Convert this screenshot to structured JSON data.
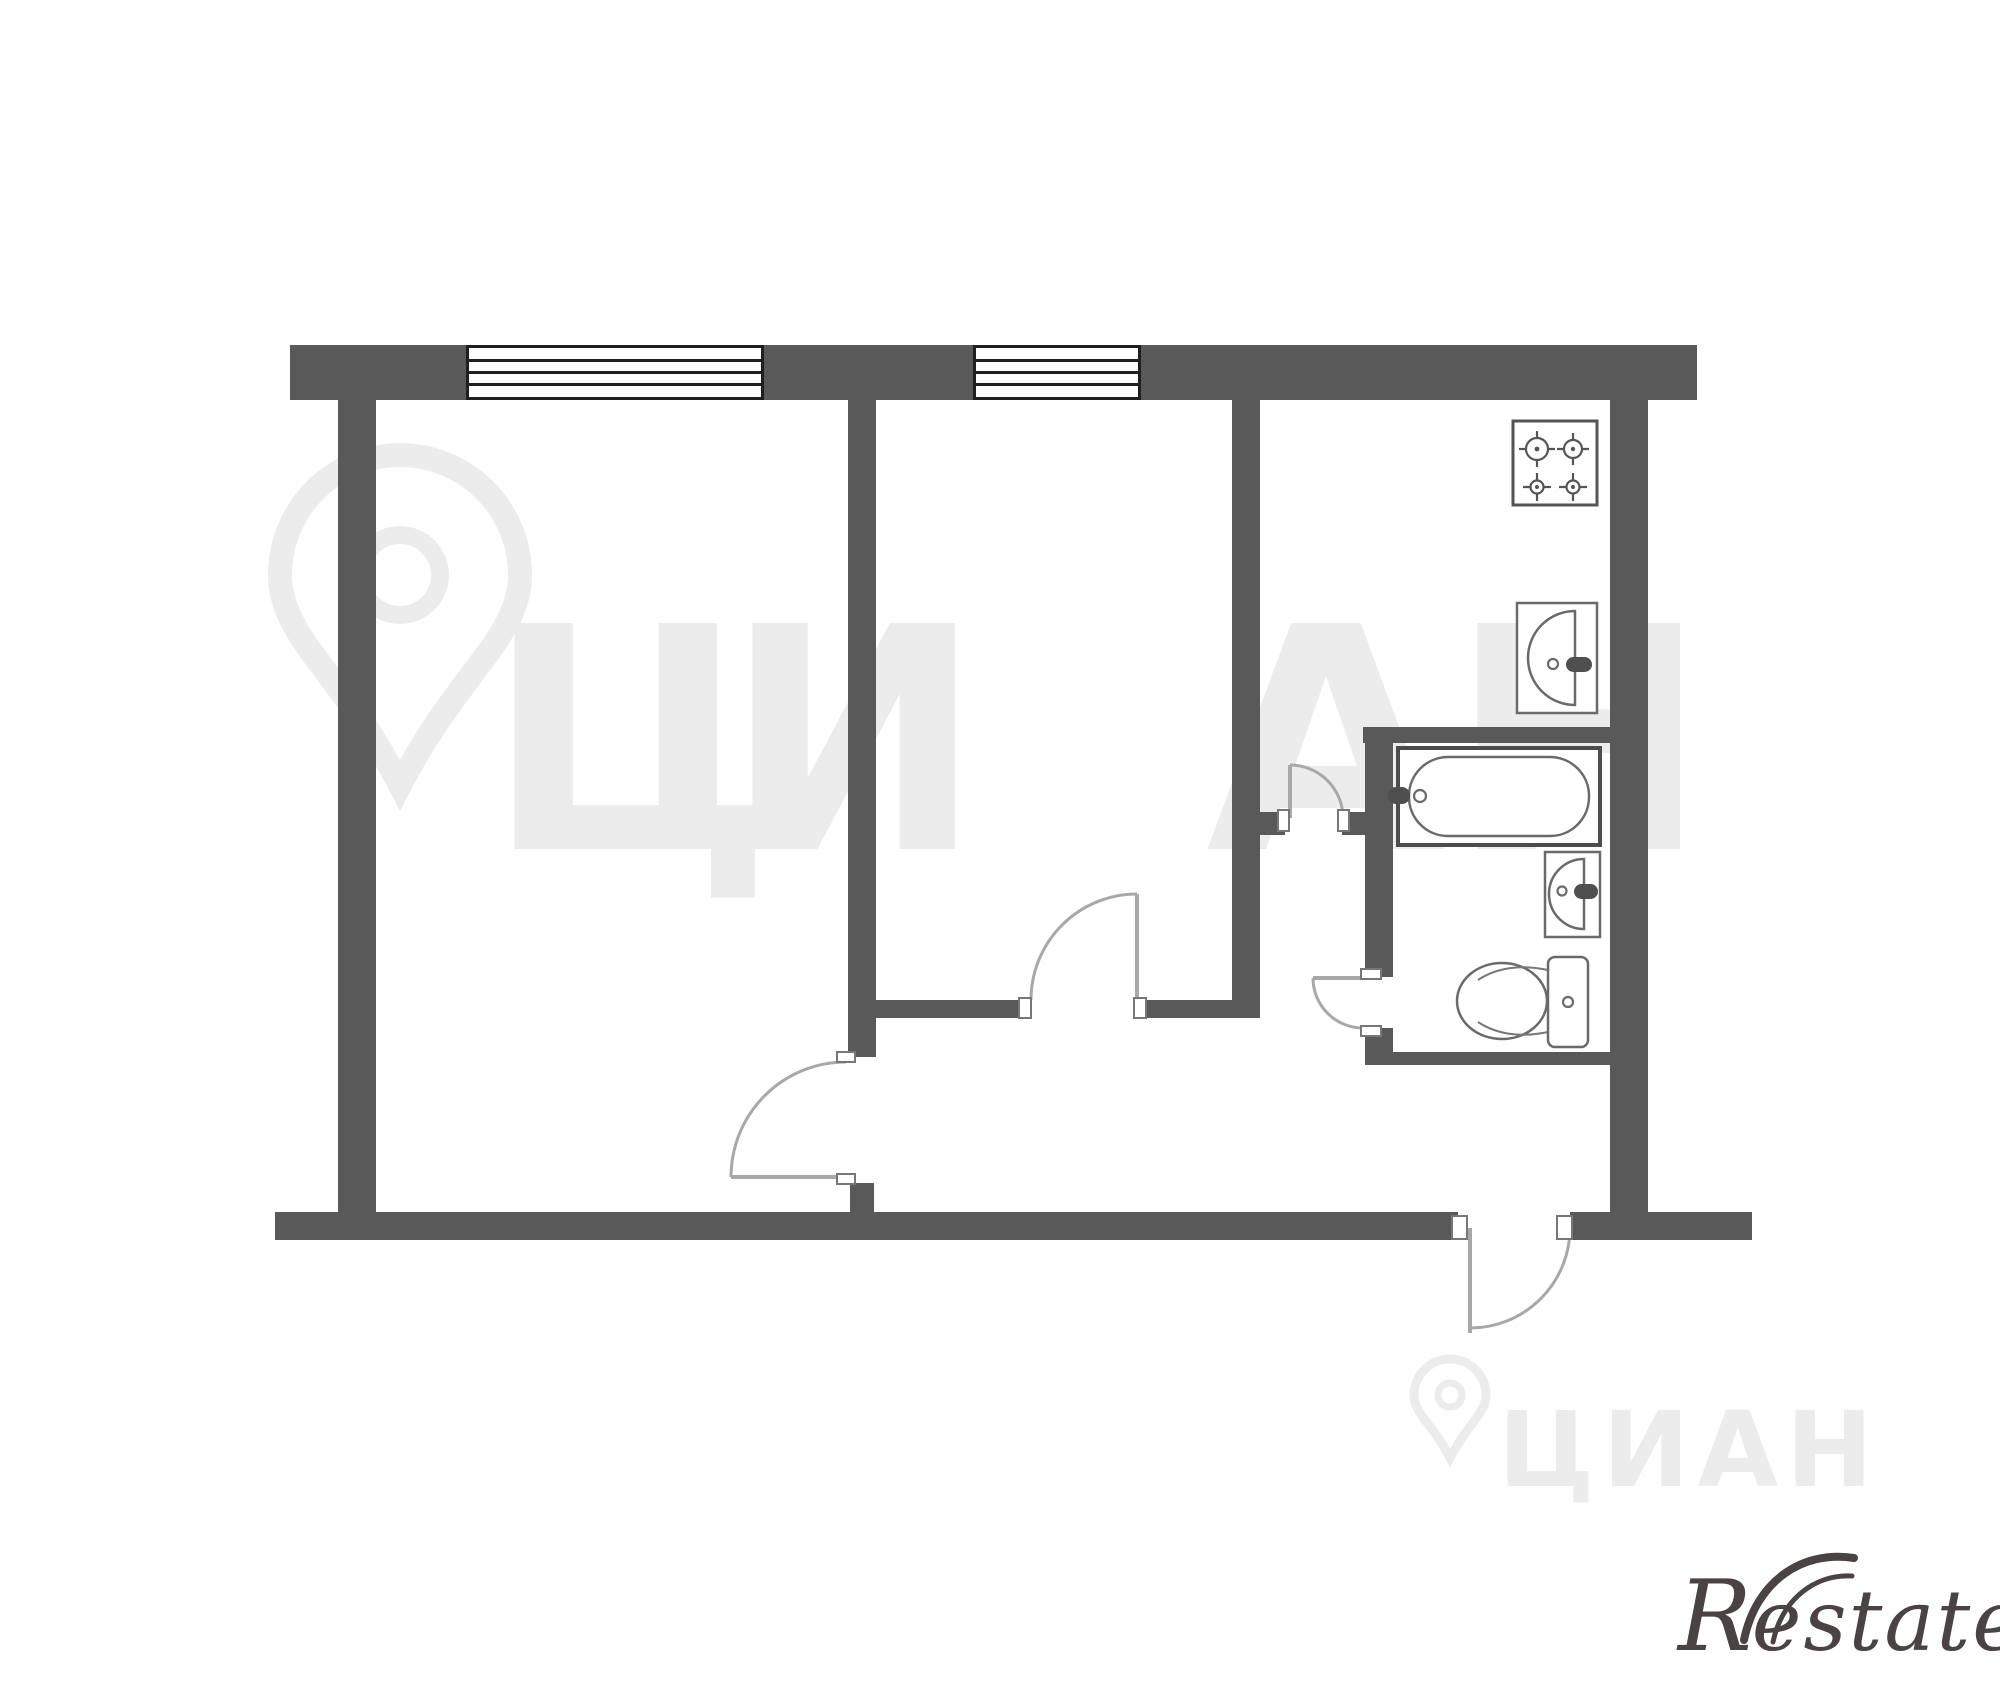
{
  "meta": {
    "width": 2000,
    "height": 1683,
    "background": "#ffffff",
    "kind": "apartment floor plan"
  },
  "colors": {
    "wall": "#595959",
    "windowframe": "#1f1f1f",
    "fixture": "#6a6a6a",
    "fixturedark": "#4f4f4f",
    "door": "#a8a8a8",
    "watermark": "#ececec",
    "logo": "#4a4343"
  },
  "plan": {
    "rooms": [
      "living-room",
      "bedroom",
      "kitchen",
      "bathroom",
      "hallway"
    ],
    "windows_count": 2,
    "doors_count": 5,
    "fixtures": [
      "stove",
      "kitchen-sink",
      "bathtub",
      "bathroom-sink",
      "toilet"
    ]
  },
  "watermarks": {
    "center_letters": [
      "Ц",
      "И",
      "А",
      "Н"
    ],
    "bottom_text": "ЦИАН"
  },
  "branding": {
    "logo_r": "R",
    "logo_rest": "estate"
  }
}
